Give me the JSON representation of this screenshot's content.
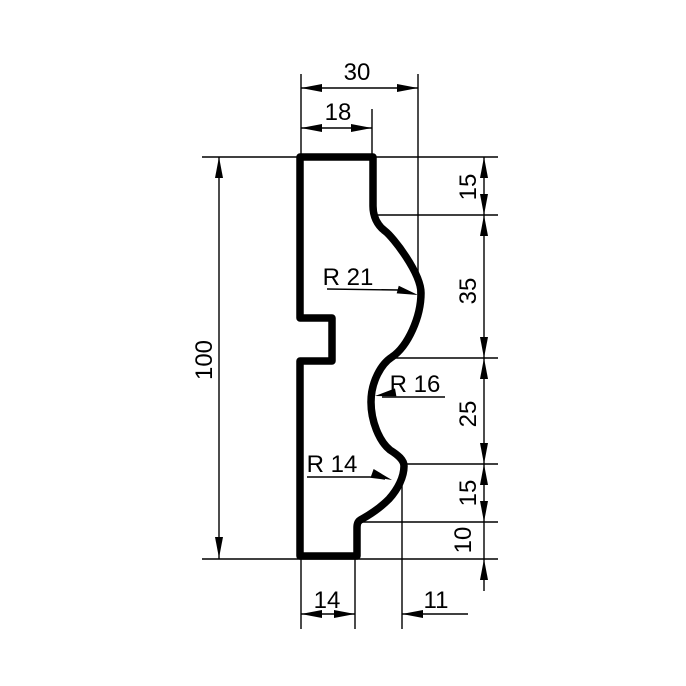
{
  "drawing": {
    "type": "technical-profile-drawing",
    "labels": {
      "width_top": "30",
      "width_top_flat": "18",
      "height_total": "100",
      "seg_top_15": "15",
      "seg_35": "35",
      "seg_25": "25",
      "seg_lower_15": "15",
      "seg_10": "10",
      "width_bottom_flat": "14",
      "offset_bottom": "11",
      "radius_large": "R 21",
      "radius_middle": "R  16",
      "radius_small": "R 14"
    },
    "colors": {
      "ink": "#000000",
      "background": "#ffffff"
    }
  }
}
